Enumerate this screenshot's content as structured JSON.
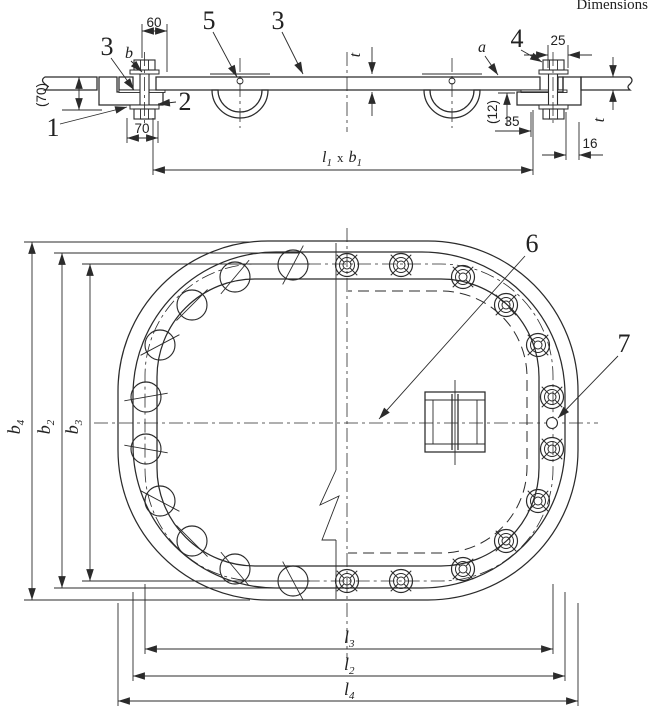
{
  "header": {
    "note": "Dimensions"
  },
  "section": {
    "items": {
      "n1": "1",
      "n2": "2",
      "n3a": "3",
      "n3b": "3",
      "n4": "4",
      "n5": "5"
    },
    "refs": {
      "a": "a",
      "b": "b",
      "t_mid": "t",
      "t_right": "t"
    },
    "dims": {
      "d60": "60",
      "d70_paren": "(70)",
      "d70": "70",
      "d25": "25",
      "d12_paren": "(12)",
      "d35": "35",
      "d16": "16",
      "l1b1": {
        "base1": "l",
        "sub1": "1",
        "times": "x",
        "base2": "b",
        "sub2": "1"
      }
    }
  },
  "plan": {
    "items": {
      "n6": "6",
      "n7": "7"
    },
    "dims": {
      "b4": {
        "base": "b",
        "sub": "4"
      },
      "b2": {
        "base": "b",
        "sub": "2"
      },
      "b3": {
        "base": "b",
        "sub": "3"
      },
      "l3": {
        "base": "l",
        "sub": "3"
      },
      "l2": {
        "base": "l",
        "sub": "2"
      },
      "l4": {
        "base": "l",
        "sub": "4"
      }
    }
  }
}
